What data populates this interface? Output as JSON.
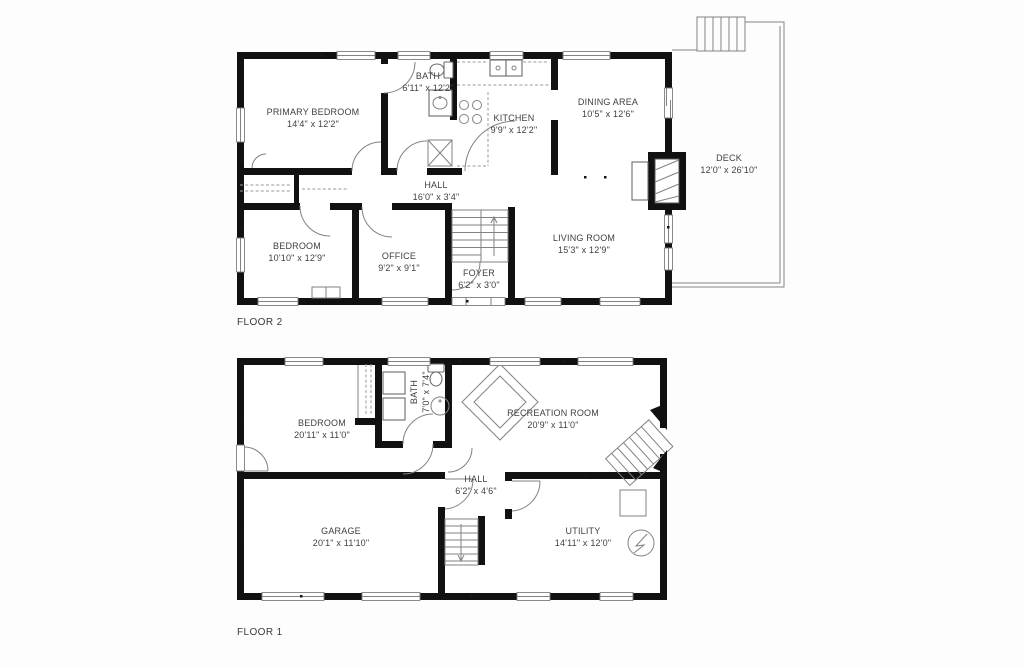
{
  "document": {
    "type": "residential floor plan",
    "floors_shown": 2
  },
  "colors": {
    "wall": "#111111",
    "thin_line": "#828282",
    "text": "#3f3f3f",
    "background": "#fdfdfd"
  },
  "floor2": {
    "label": "FLOOR 2",
    "rooms": {
      "primary_bedroom": {
        "name": "PRIMARY BEDROOM",
        "dims": "14'4\" x 12'2\""
      },
      "bath": {
        "name": "BATH",
        "dims": "6'11\" x 12'2\""
      },
      "kitchen": {
        "name": "KITCHEN",
        "dims": "9'9\" x 12'2\""
      },
      "dining": {
        "name": "DINING AREA",
        "dims": "10'5\" x 12'6\""
      },
      "deck": {
        "name": "DECK",
        "dims": "12'0\" x 26'10\""
      },
      "hall": {
        "name": "HALL",
        "dims": "16'0\" x 3'4\""
      },
      "bedroom": {
        "name": "BEDROOM",
        "dims": "10'10\" x 12'9\""
      },
      "office": {
        "name": "OFFICE",
        "dims": "9'2\" x 9'1\""
      },
      "foyer": {
        "name": "FOYER",
        "dims": "6'2\" x 3'0\""
      },
      "living": {
        "name": "LIVING ROOM",
        "dims": "15'3\" x 12'9\""
      }
    },
    "fixtures": [
      "toilet",
      "vanity-sink",
      "shower",
      "kitchen-sink",
      "stove",
      "fireplace",
      "closet-rails",
      "foyer-stairs",
      "deck-stairs"
    ]
  },
  "floor1": {
    "label": "FLOOR 1",
    "rooms": {
      "bedroom": {
        "name": "BEDROOM",
        "dims": "20'11\" x 11'0\""
      },
      "bath": {
        "name": "BATH",
        "dims": "7'0\" x 7'4\""
      },
      "recreation": {
        "name": "RECREATION ROOM",
        "dims": "20'9\" x 11'0\""
      },
      "hall": {
        "name": "HALL",
        "dims": "6'2\" x 4'6\""
      },
      "garage": {
        "name": "GARAGE",
        "dims": "20'1\" x 11'10\""
      },
      "utility": {
        "name": "UTILITY",
        "dims": "14'11\" x 12'0\""
      }
    },
    "fixtures": [
      "toilet",
      "sink",
      "shower-closet",
      "closet-rails",
      "table",
      "winder-stairs",
      "basement-stairs",
      "water-heater",
      "electrical-panel",
      "garage-doors"
    ]
  }
}
